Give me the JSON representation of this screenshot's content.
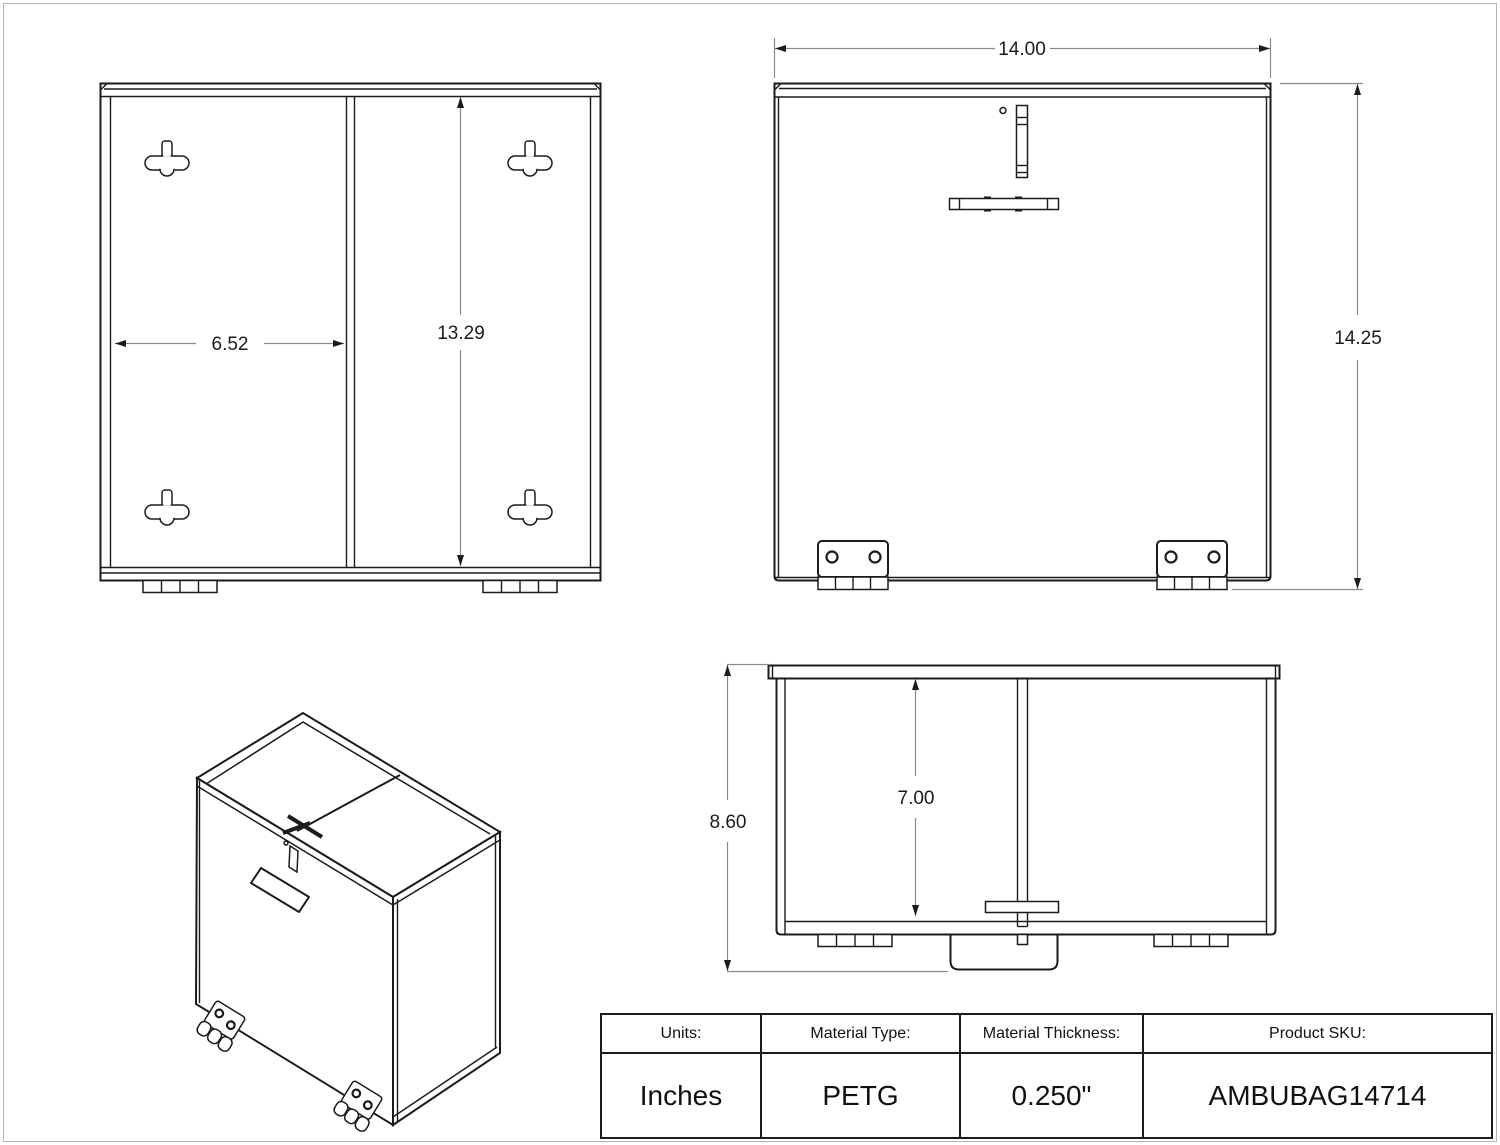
{
  "drawing": {
    "back_view": {
      "inner_width_dim": "6.52",
      "inner_height_dim": "13.29"
    },
    "front_view": {
      "width_dim": "14.00",
      "height_dim": "14.25"
    },
    "top_view": {
      "depth_dim": "8.60",
      "inner_depth_dim": "7.00"
    }
  },
  "title_block": {
    "columns": [
      {
        "header": "Units:",
        "value": "Inches"
      },
      {
        "header": "Material Type:",
        "value": "PETG"
      },
      {
        "header": "Material Thickness:",
        "value": "0.250\""
      },
      {
        "header": "Product SKU:",
        "value": "AMBUBAG14714"
      }
    ]
  }
}
